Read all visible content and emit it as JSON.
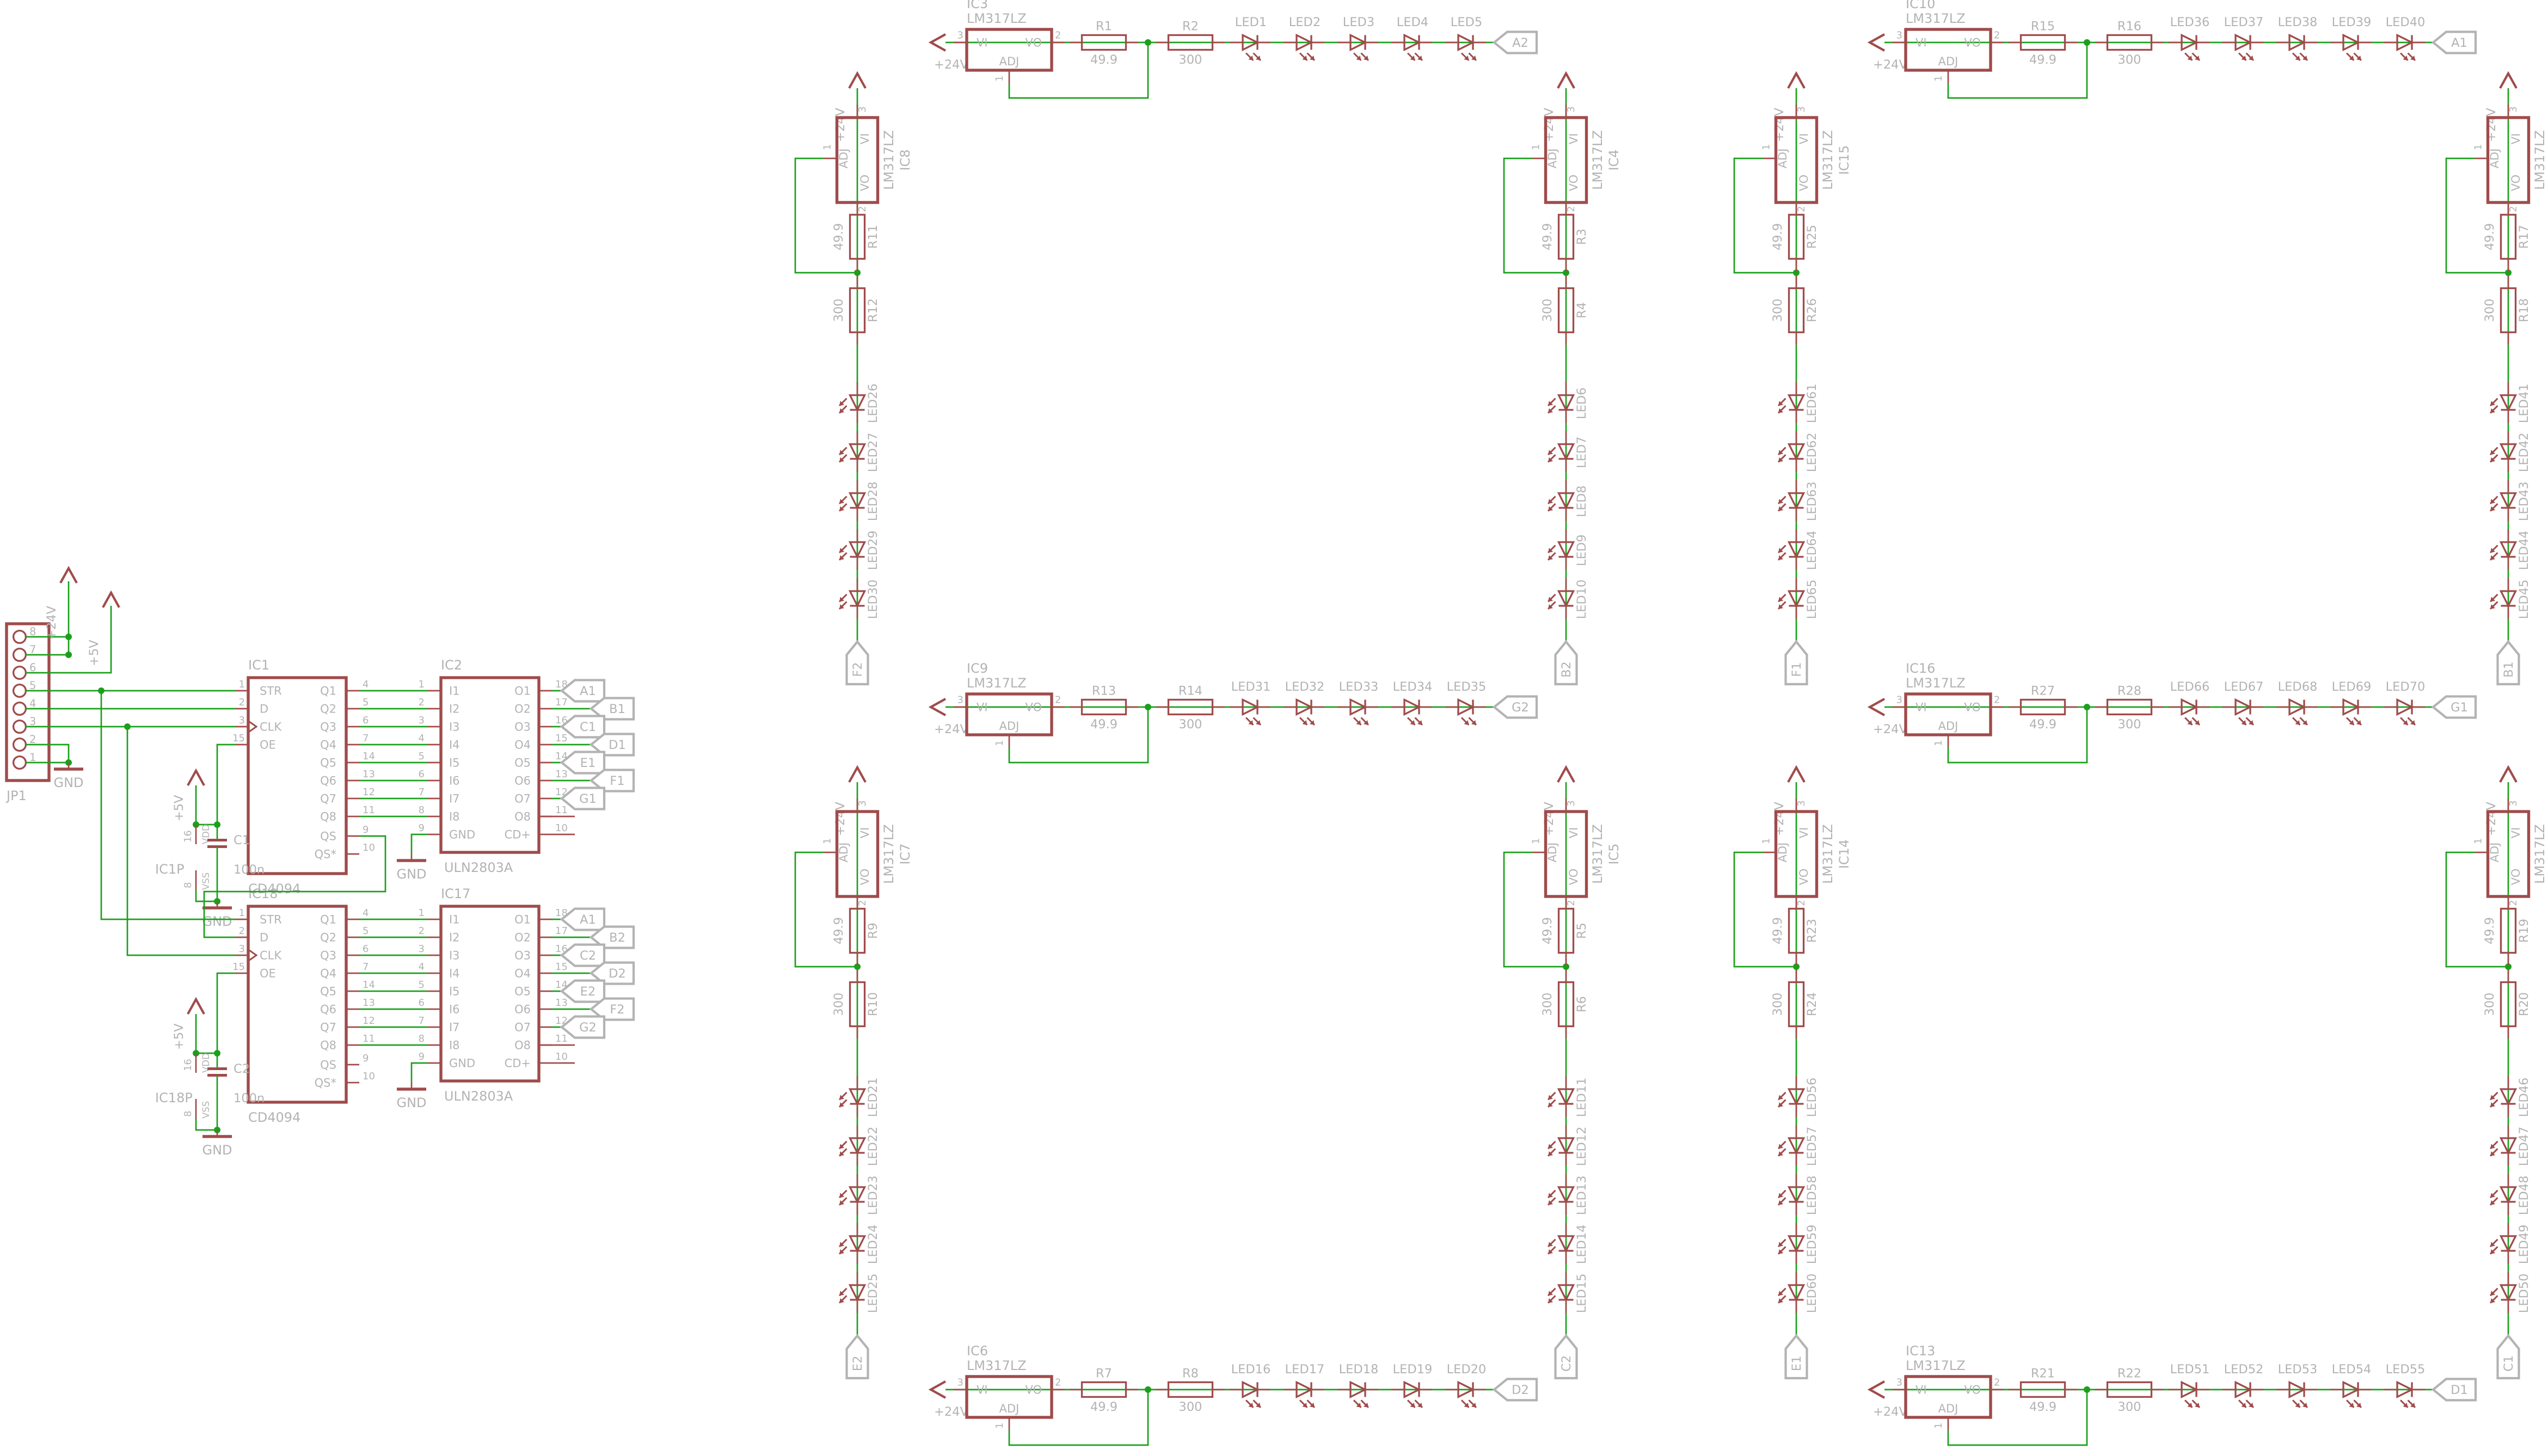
{
  "colors": {
    "wire": "#1ba01b",
    "component": "#a04b4b",
    "label": "#b3b3b3",
    "background": "#ffffff"
  },
  "power": {
    "v24": "+24V",
    "v5": "+5V",
    "gnd": "GND"
  },
  "reg": {
    "vi": "VI",
    "vo": "VO",
    "adj": "ADJ",
    "pin_vi": "3",
    "pin_vo": "2",
    "pin_adj": "1"
  },
  "connector": {
    "name": "JP1",
    "pins": [
      "8",
      "7",
      "6",
      "5",
      "4",
      "3",
      "2",
      "1"
    ]
  },
  "logic": [
    {
      "name": "IC1",
      "part": "CD4094",
      "left_pins": [
        {
          "n": "1",
          "label": "STR"
        },
        {
          "n": "2",
          "label": "D"
        },
        {
          "n": "3",
          "label": "CLK"
        },
        {
          "n": "15",
          "label": "OE"
        }
      ],
      "right_pins": [
        {
          "n": "4",
          "label": "Q1"
        },
        {
          "n": "5",
          "label": "Q2"
        },
        {
          "n": "6",
          "label": "Q3"
        },
        {
          "n": "7",
          "label": "Q4"
        },
        {
          "n": "14",
          "label": "Q5"
        },
        {
          "n": "13",
          "label": "Q6"
        },
        {
          "n": "12",
          "label": "Q7"
        },
        {
          "n": "11",
          "label": "Q8"
        }
      ],
      "serial_pins": [
        {
          "n": "9",
          "label": "QS"
        },
        {
          "n": "10",
          "label": "QS*"
        }
      ],
      "power_part": {
        "name": "IC1P",
        "vdd_pin": {
          "n": "16",
          "label": "VDD"
        },
        "vss_pin": {
          "n": "8",
          "label": "VSS"
        },
        "cap": {
          "name": "C1",
          "value": "100n"
        }
      }
    },
    {
      "name": "IC18",
      "part": "CD4094",
      "left_pins": [
        {
          "n": "1",
          "label": "STR"
        },
        {
          "n": "2",
          "label": "D"
        },
        {
          "n": "3",
          "label": "CLK"
        },
        {
          "n": "15",
          "label": "OE"
        }
      ],
      "right_pins": [
        {
          "n": "4",
          "label": "Q1"
        },
        {
          "n": "5",
          "label": "Q2"
        },
        {
          "n": "6",
          "label": "Q3"
        },
        {
          "n": "7",
          "label": "Q4"
        },
        {
          "n": "14",
          "label": "Q5"
        },
        {
          "n": "13",
          "label": "Q6"
        },
        {
          "n": "12",
          "label": "Q7"
        },
        {
          "n": "11",
          "label": "Q8"
        }
      ],
      "serial_pins": [
        {
          "n": "9",
          "label": "QS"
        },
        {
          "n": "10",
          "label": "QS*"
        }
      ],
      "power_part": {
        "name": "IC18P",
        "vdd_pin": {
          "n": "16",
          "label": "VDD"
        },
        "vss_pin": {
          "n": "8",
          "label": "VSS"
        },
        "cap": {
          "name": "C2",
          "value": "100n"
        }
      }
    }
  ],
  "buffers": [
    {
      "name": "IC2",
      "part": "ULN2803A",
      "inputs": [
        {
          "n": "1",
          "label": "I1"
        },
        {
          "n": "2",
          "label": "I2"
        },
        {
          "n": "3",
          "label": "I3"
        },
        {
          "n": "4",
          "label": "I4"
        },
        {
          "n": "5",
          "label": "I5"
        },
        {
          "n": "6",
          "label": "I6"
        },
        {
          "n": "7",
          "label": "I7"
        },
        {
          "n": "8",
          "label": "I8"
        }
      ],
      "gnd_pin": {
        "n": "9",
        "label": "GND"
      },
      "cd_pin": {
        "n": "10",
        "label": "CD+"
      },
      "outputs": [
        {
          "n": "18",
          "label": "O1",
          "flag": "A1"
        },
        {
          "n": "17",
          "label": "O2",
          "flag": "B1"
        },
        {
          "n": "16",
          "label": "O3",
          "flag": "C1"
        },
        {
          "n": "15",
          "label": "O4",
          "flag": "D1"
        },
        {
          "n": "14",
          "label": "O5",
          "flag": "E1"
        },
        {
          "n": "13",
          "label": "O6",
          "flag": "F1"
        },
        {
          "n": "12",
          "label": "O7",
          "flag": "G1"
        },
        {
          "n": "11",
          "label": "O8",
          "flag": null
        }
      ]
    },
    {
      "name": "IC17",
      "part": "ULN2803A",
      "inputs": [
        {
          "n": "1",
          "label": "I1"
        },
        {
          "n": "2",
          "label": "I2"
        },
        {
          "n": "3",
          "label": "I3"
        },
        {
          "n": "4",
          "label": "I4"
        },
        {
          "n": "5",
          "label": "I5"
        },
        {
          "n": "6",
          "label": "I6"
        },
        {
          "n": "7",
          "label": "I7"
        },
        {
          "n": "8",
          "label": "I8"
        }
      ],
      "gnd_pin": {
        "n": "9",
        "label": "GND"
      },
      "cd_pin": {
        "n": "10",
        "label": "CD+"
      },
      "outputs": [
        {
          "n": "18",
          "label": "O1",
          "flag": "A1"
        },
        {
          "n": "17",
          "label": "O2",
          "flag": "B2"
        },
        {
          "n": "16",
          "label": "O3",
          "flag": "C2"
        },
        {
          "n": "15",
          "label": "O4",
          "flag": "D2"
        },
        {
          "n": "14",
          "label": "O5",
          "flag": "E2"
        },
        {
          "n": "13",
          "label": "O6",
          "flag": "F2"
        },
        {
          "n": "12",
          "label": "O7",
          "flag": "G2"
        },
        {
          "n": "11",
          "label": "O8",
          "flag": null
        }
      ]
    }
  ],
  "drivers": [
    {
      "name": "IC3",
      "part": "LM317LZ",
      "r_set": {
        "name": "R1",
        "value": "49.9"
      },
      "r_out": {
        "name": "R2",
        "value": "300"
      },
      "leds": [
        "LED1",
        "LED2",
        "LED3",
        "LED4",
        "LED5"
      ],
      "net": "A2"
    },
    {
      "name": "IC4",
      "part": "LM317LZ",
      "r_set": {
        "name": "R3",
        "value": "49.9"
      },
      "r_out": {
        "name": "R4",
        "value": "300"
      },
      "leds": [
        "LED6",
        "LED7",
        "LED8",
        "LED9",
        "LED10"
      ],
      "net": "B2"
    },
    {
      "name": "IC5",
      "part": "LM317LZ",
      "r_set": {
        "name": "R5",
        "value": "49.9"
      },
      "r_out": {
        "name": "R6",
        "value": "300"
      },
      "leds": [
        "LED11",
        "LED12",
        "LED13",
        "LED14",
        "LED15"
      ],
      "net": "C2"
    },
    {
      "name": "IC6",
      "part": "LM317LZ",
      "r_set": {
        "name": "R7",
        "value": "49.9"
      },
      "r_out": {
        "name": "R8",
        "value": "300"
      },
      "leds": [
        "LED16",
        "LED17",
        "LED18",
        "LED19",
        "LED20"
      ],
      "net": "D2"
    },
    {
      "name": "IC7",
      "part": "LM317LZ",
      "r_set": {
        "name": "R9",
        "value": "49.9"
      },
      "r_out": {
        "name": "R10",
        "value": "300"
      },
      "leds": [
        "LED21",
        "LED22",
        "LED23",
        "LED24",
        "LED25"
      ],
      "net": "E2"
    },
    {
      "name": "IC8",
      "part": "LM317LZ",
      "r_set": {
        "name": "R11",
        "value": "49.9"
      },
      "r_out": {
        "name": "R12",
        "value": "300"
      },
      "leds": [
        "LED26",
        "LED27",
        "LED28",
        "LED29",
        "LED30"
      ],
      "net": "F2"
    },
    {
      "name": "IC9",
      "part": "LM317LZ",
      "r_set": {
        "name": "R13",
        "value": "49.9"
      },
      "r_out": {
        "name": "R14",
        "value": "300"
      },
      "leds": [
        "LED31",
        "LED32",
        "LED33",
        "LED34",
        "LED35"
      ],
      "net": "G2"
    },
    {
      "name": "IC10",
      "part": "LM317LZ",
      "r_set": {
        "name": "R15",
        "value": "49.9"
      },
      "r_out": {
        "name": "R16",
        "value": "300"
      },
      "leds": [
        "LED36",
        "LED37",
        "LED38",
        "LED39",
        "LED40"
      ],
      "net": "A1"
    },
    {
      "name": "IC11",
      "part": "LM317LZ",
      "r_set": {
        "name": "R17",
        "value": "49.9"
      },
      "r_out": {
        "name": "R18",
        "value": "300"
      },
      "leds": [
        "LED41",
        "LED42",
        "LED43",
        "LED44",
        "LED45"
      ],
      "net": "B1"
    },
    {
      "name": "IC12",
      "part": "LM317LZ",
      "r_set": {
        "name": "R19",
        "value": "49.9"
      },
      "r_out": {
        "name": "R20",
        "value": "300"
      },
      "leds": [
        "LED46",
        "LED47",
        "LED48",
        "LED49",
        "LED50"
      ],
      "net": "C1"
    },
    {
      "name": "IC13",
      "part": "LM317LZ",
      "r_set": {
        "name": "R21",
        "value": "49.9"
      },
      "r_out": {
        "name": "R22",
        "value": "300"
      },
      "leds": [
        "LED51",
        "LED52",
        "LED53",
        "LED54",
        "LED55"
      ],
      "net": "D1"
    },
    {
      "name": "IC14",
      "part": "LM317LZ",
      "r_set": {
        "name": "R23",
        "value": "49.9"
      },
      "r_out": {
        "name": "R24",
        "value": "300"
      },
      "leds": [
        "LED56",
        "LED57",
        "LED58",
        "LED59",
        "LED60"
      ],
      "net": "E1"
    },
    {
      "name": "IC15",
      "part": "LM317LZ",
      "r_set": {
        "name": "R25",
        "value": "49.9"
      },
      "r_out": {
        "name": "R26",
        "value": "300"
      },
      "leds": [
        "LED61",
        "LED62",
        "LED63",
        "LED64",
        "LED65"
      ],
      "net": "F1"
    },
    {
      "name": "IC16",
      "part": "LM317LZ",
      "r_set": {
        "name": "R27",
        "value": "49.9"
      },
      "r_out": {
        "name": "R28",
        "value": "300"
      },
      "leds": [
        "LED66",
        "LED67",
        "LED68",
        "LED69",
        "LED70"
      ],
      "net": "G1"
    }
  ]
}
